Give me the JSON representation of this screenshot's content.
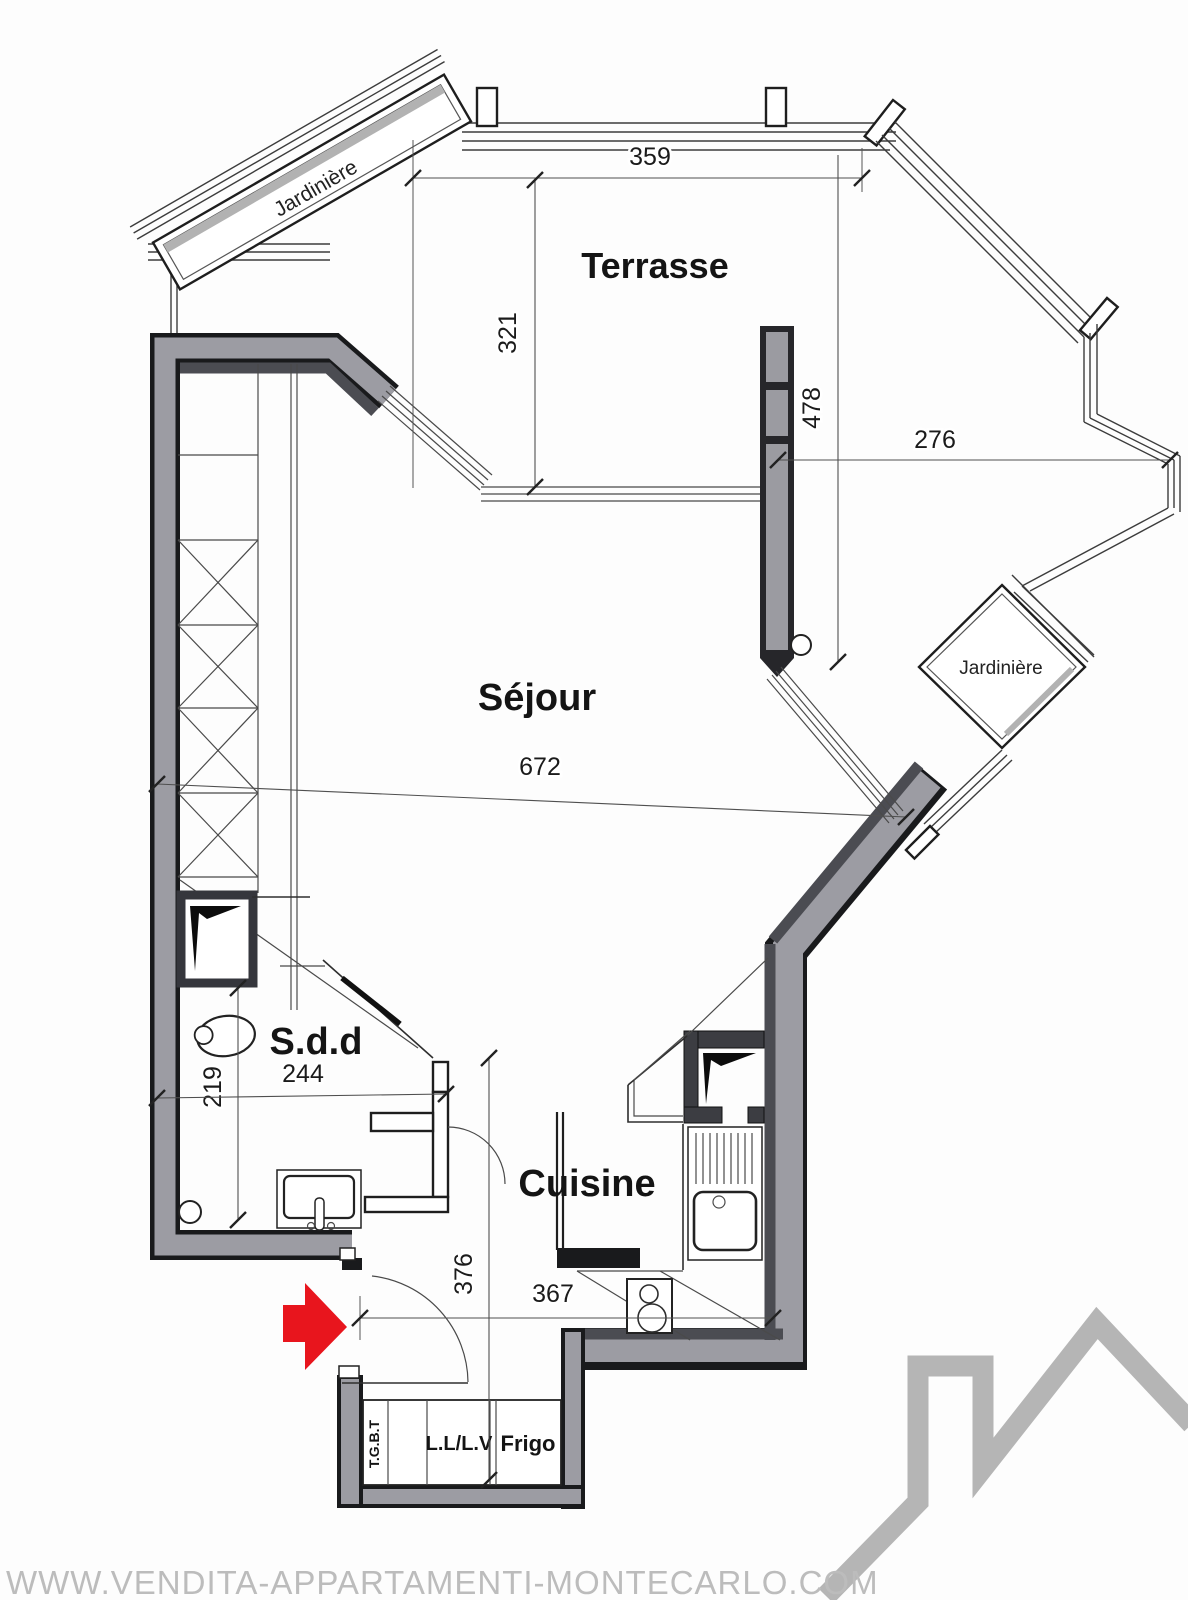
{
  "rooms": {
    "terrace": "Terrasse",
    "living": "Séjour",
    "bathroom": "S.d.d",
    "kitchen": "Cuisine"
  },
  "planters": {
    "top": "Jardinière",
    "right": "Jardinière"
  },
  "equipment": {
    "main_panel": "T.G.B.T",
    "washer_dishwasher": "L.L/L.V",
    "fridge": "Frigo"
  },
  "dims": {
    "terrace_width": "359",
    "terrace_depth": "321",
    "living_height": "478",
    "terrace_right_width": "276",
    "living_width": "672",
    "bath_depth": "219",
    "bath_width": "244",
    "hall_height": "376",
    "kitchen_width": "367"
  },
  "footer": {
    "watermark": "WWW.VENDITA-APPARTAMENTI-MONTECARLO.COM"
  },
  "colors": {
    "wall_gray": "#9c9ca3",
    "wall_dark_band": "#4b4c52",
    "wall_outline": "#191a1c",
    "arrow_red": "#e8151d",
    "watermark_gray": "#bcbcbc",
    "logo_gray": "#b5b5b5"
  }
}
